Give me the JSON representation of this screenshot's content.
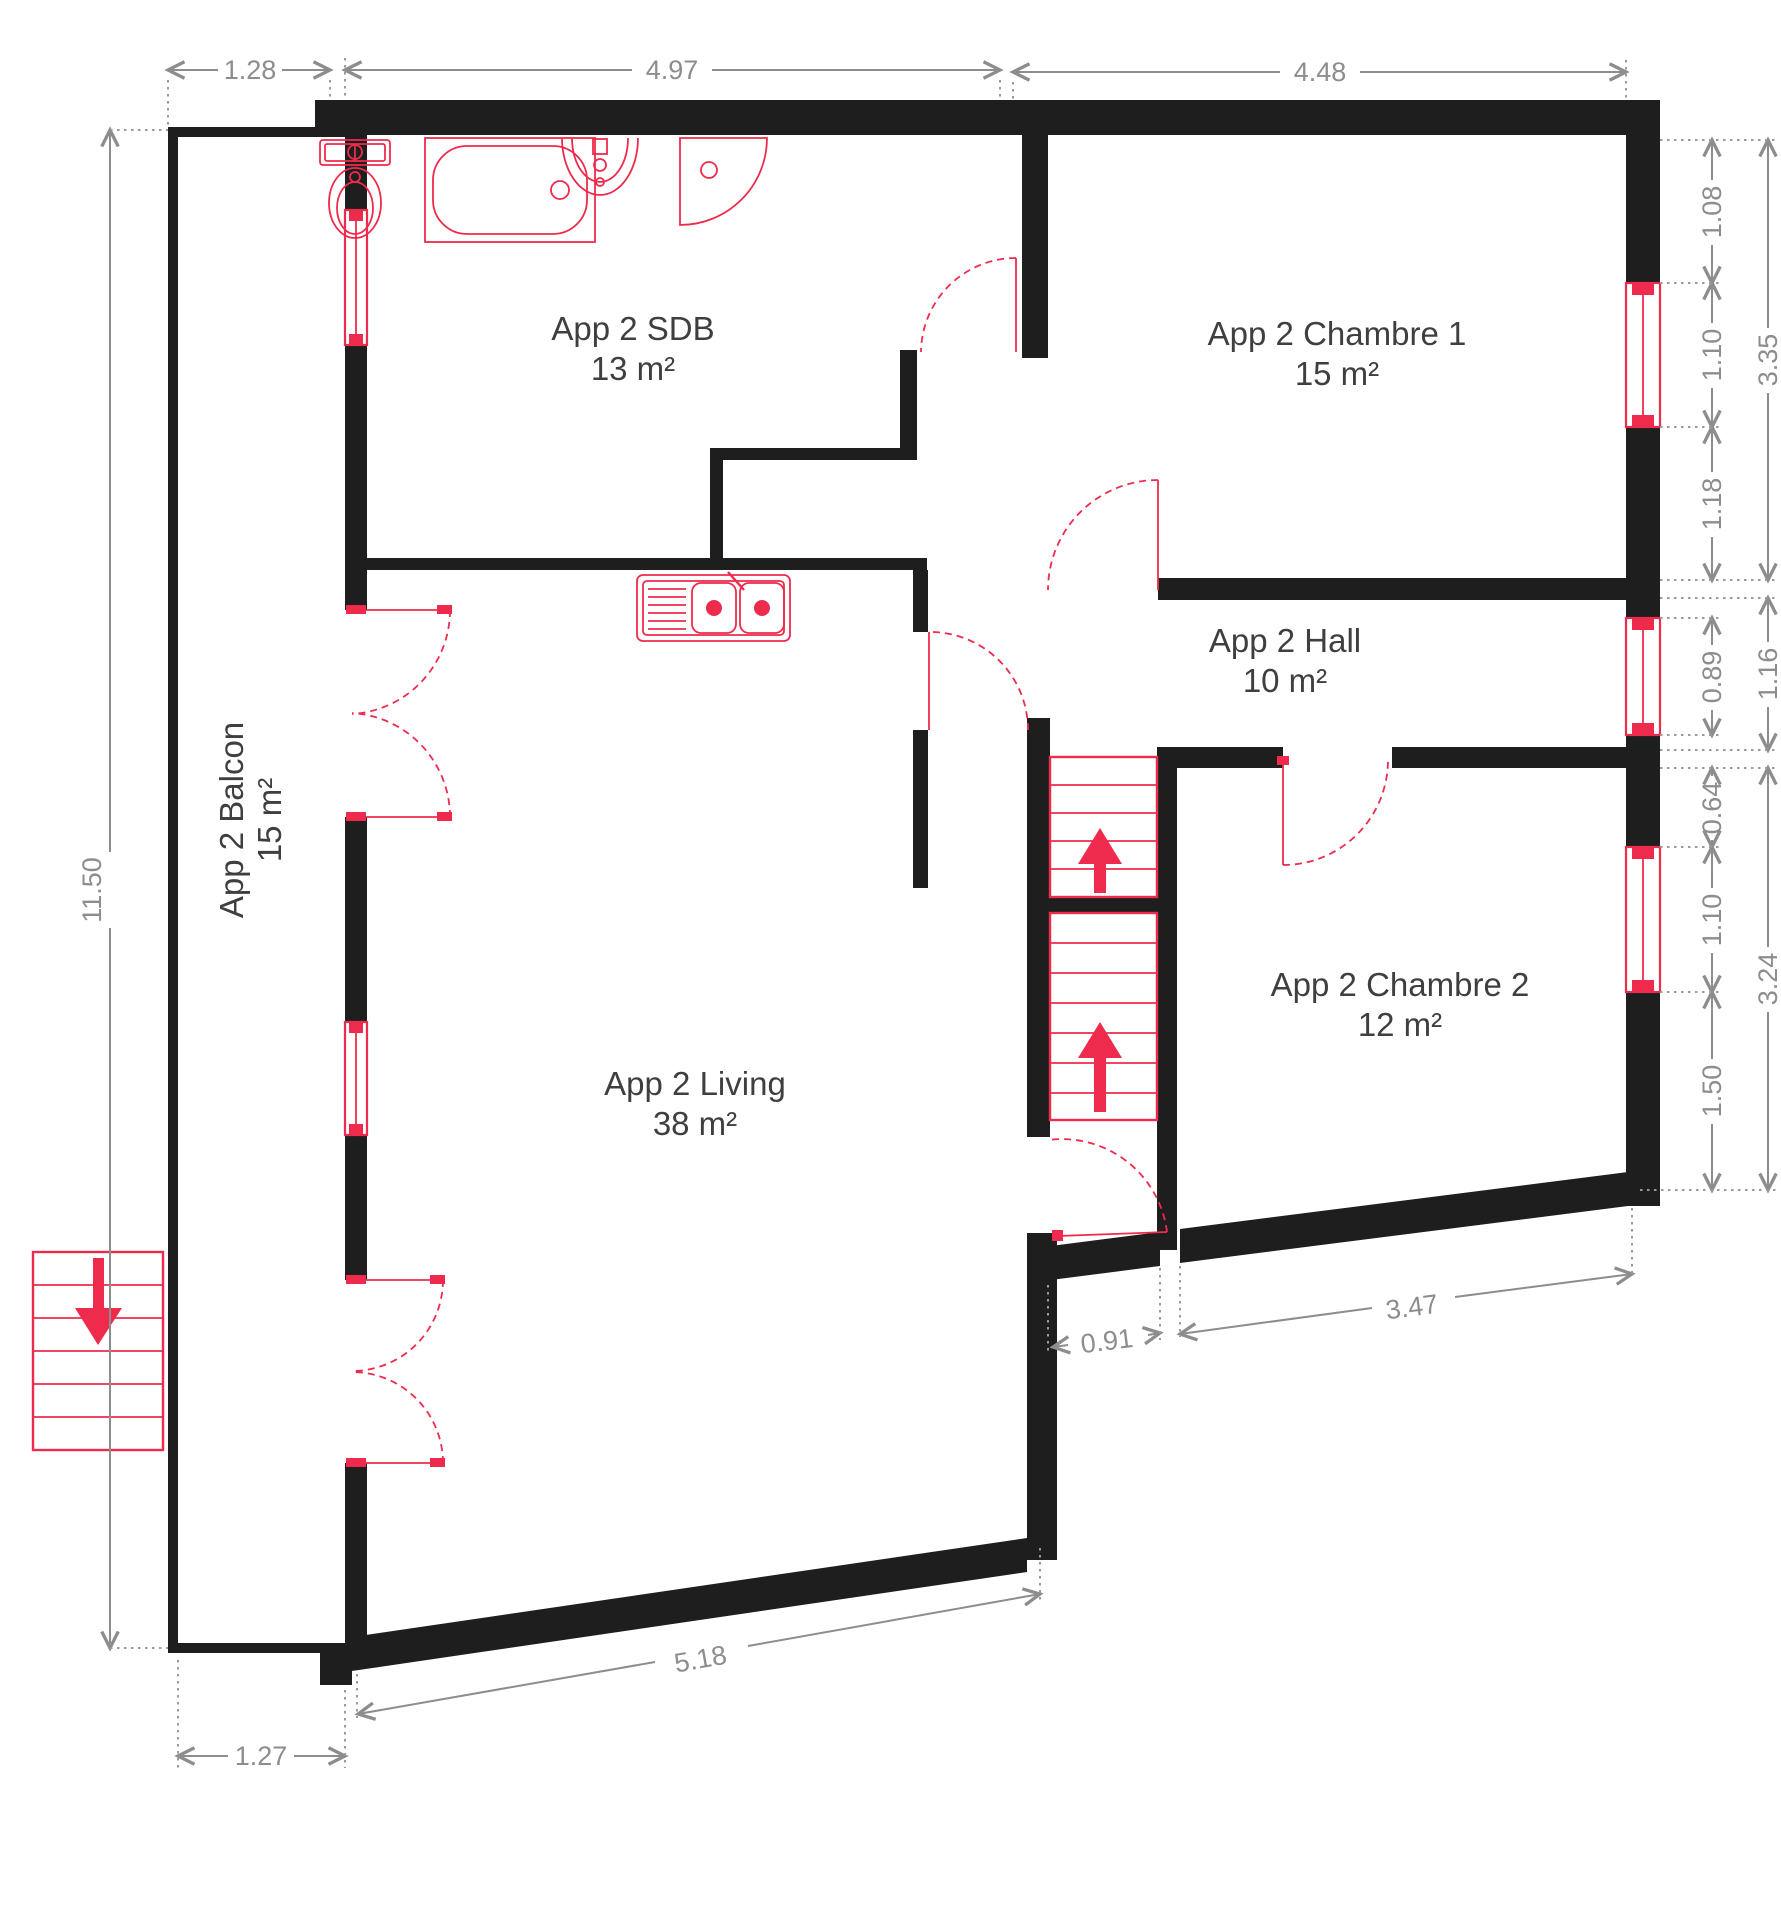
{
  "rooms": {
    "sdb": {
      "label": "App 2 SDB",
      "area": "13 m²"
    },
    "chambre1": {
      "label": "App 2 Chambre 1",
      "area": "15 m²"
    },
    "hall": {
      "label": "App 2 Hall",
      "area": "10 m²"
    },
    "chambre2": {
      "label": "App 2 Chambre 2",
      "area": "12 m²"
    },
    "living": {
      "label": "App 2 Living",
      "area": "38 m²"
    },
    "balcon": {
      "label": "App 2 Balcon",
      "area": "15 m²"
    }
  },
  "dimensions": {
    "balcony_width_top": "1.28",
    "sdb_width": "4.97",
    "chambre1_width": "4.48",
    "chambre1_wall_upper": "1.08",
    "chambre1_window": "1.10",
    "chambre1_wall_lower": "1.18",
    "chambre1_side_total": "3.35",
    "hall_window": "0.89",
    "hall_side_total": "1.16",
    "chambre2_wall_upper": "0.64",
    "chambre2_window": "1.10",
    "chambre2_wall_lower": "1.50",
    "chambre2_side_total": "3.24",
    "left_height_total": "11.50",
    "balcony_width_bottom": "1.27",
    "living_south_wall": "5.18",
    "entry_width": "0.91",
    "chambre2_south_wall": "3.47"
  },
  "colors": {
    "wall": "#1e1e1e",
    "fixtures_and_openings": "#ee2b4c",
    "dimension_lines": "#8d8d8d",
    "room_labels": "#3f3f3f",
    "background": "#ffffff"
  }
}
